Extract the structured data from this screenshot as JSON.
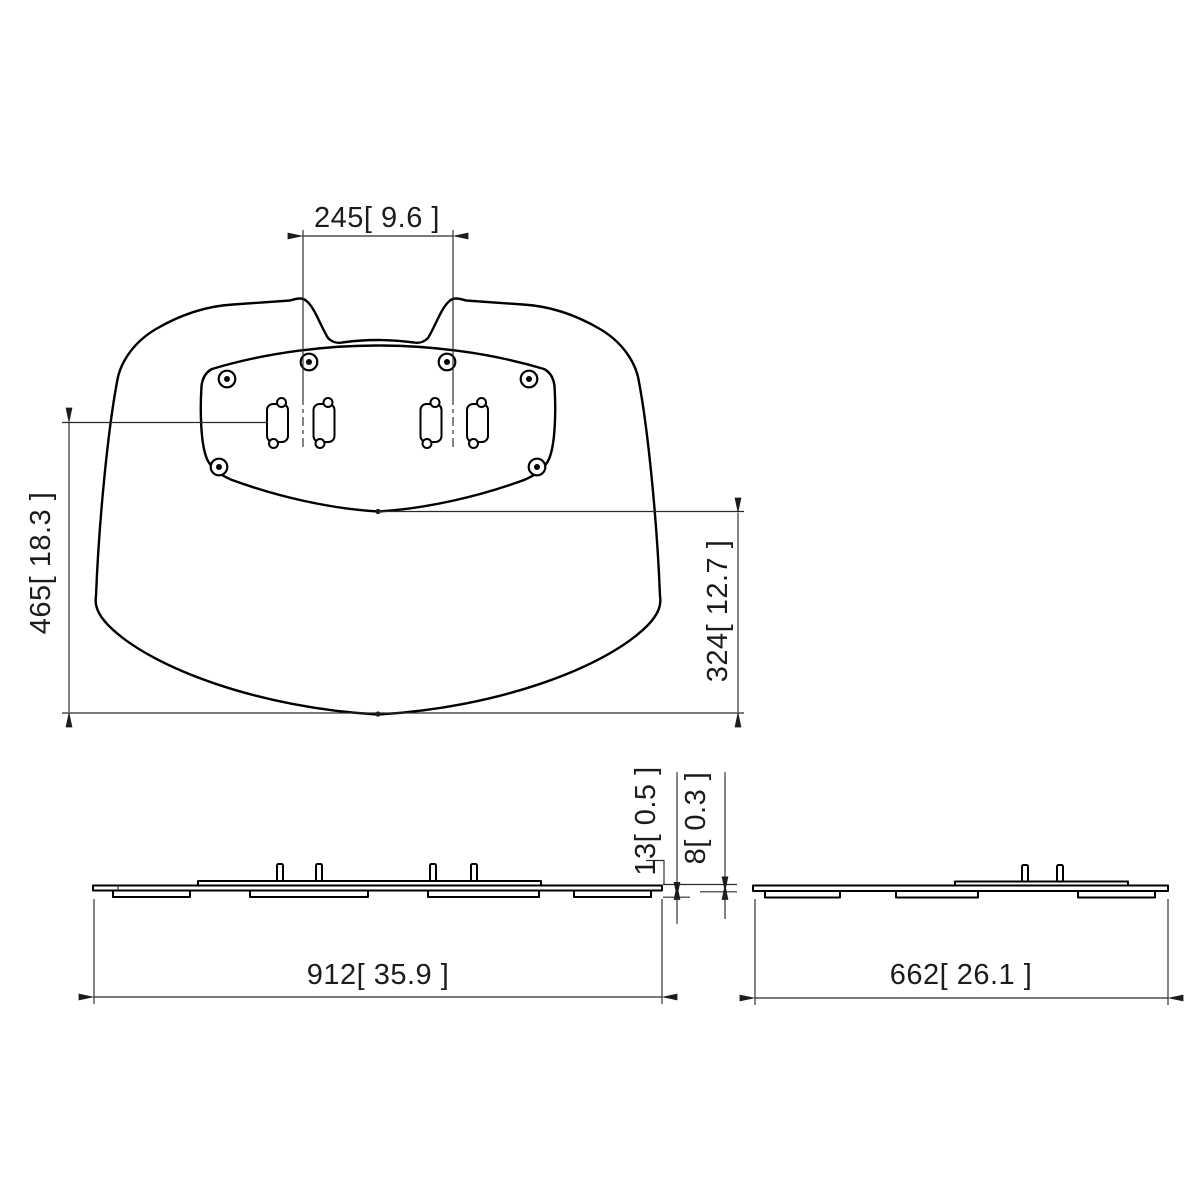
{
  "meta": {
    "drawing_type": "technical dimension drawing",
    "subject": "TV floor-stand base plate, three orthographic views",
    "units": "millimetres [inches]"
  },
  "colors": {
    "background": "#ffffff",
    "object_line": "#000000",
    "dimension_line": "#2a2a2a",
    "text": "#1c1c1c"
  },
  "top_view": {
    "name": "base plate top view",
    "dimensions": {
      "slot_pair_spacing": {
        "mm": 245,
        "inch": 9.6,
        "label": "245[ 9.6 ]"
      },
      "total_depth": {
        "mm": 465,
        "inch": 18.3,
        "label": "465[ 18.3 ]"
      },
      "rear_depth": {
        "mm": 324,
        "inch": 12.7,
        "label": "324[ 12.7 ]"
      }
    },
    "features": {
      "screw_holes": 6,
      "mount_slots": 4,
      "mount_tabs": 2
    }
  },
  "front_view": {
    "name": "base plate front elevation",
    "dimensions": {
      "total_width": {
        "mm": 912,
        "inch": 35.9,
        "label": "912[ 35.9 ]"
      },
      "height_with_feet": {
        "mm": 13,
        "inch": 0.5,
        "label": "13[ 0.5 ]"
      },
      "plate_thickness": {
        "mm": 8,
        "inch": 0.3,
        "label": "8[ 0.3 ]"
      }
    },
    "features": {
      "alignment_pins": 4,
      "foot_pads": 4
    }
  },
  "side_view": {
    "name": "base plate side elevation",
    "dimensions": {
      "total_depth": {
        "mm": 662,
        "inch": 26.1,
        "label": "662[ 26.1 ]"
      }
    },
    "features": {
      "alignment_pins": 2,
      "foot_pads": 3
    }
  }
}
